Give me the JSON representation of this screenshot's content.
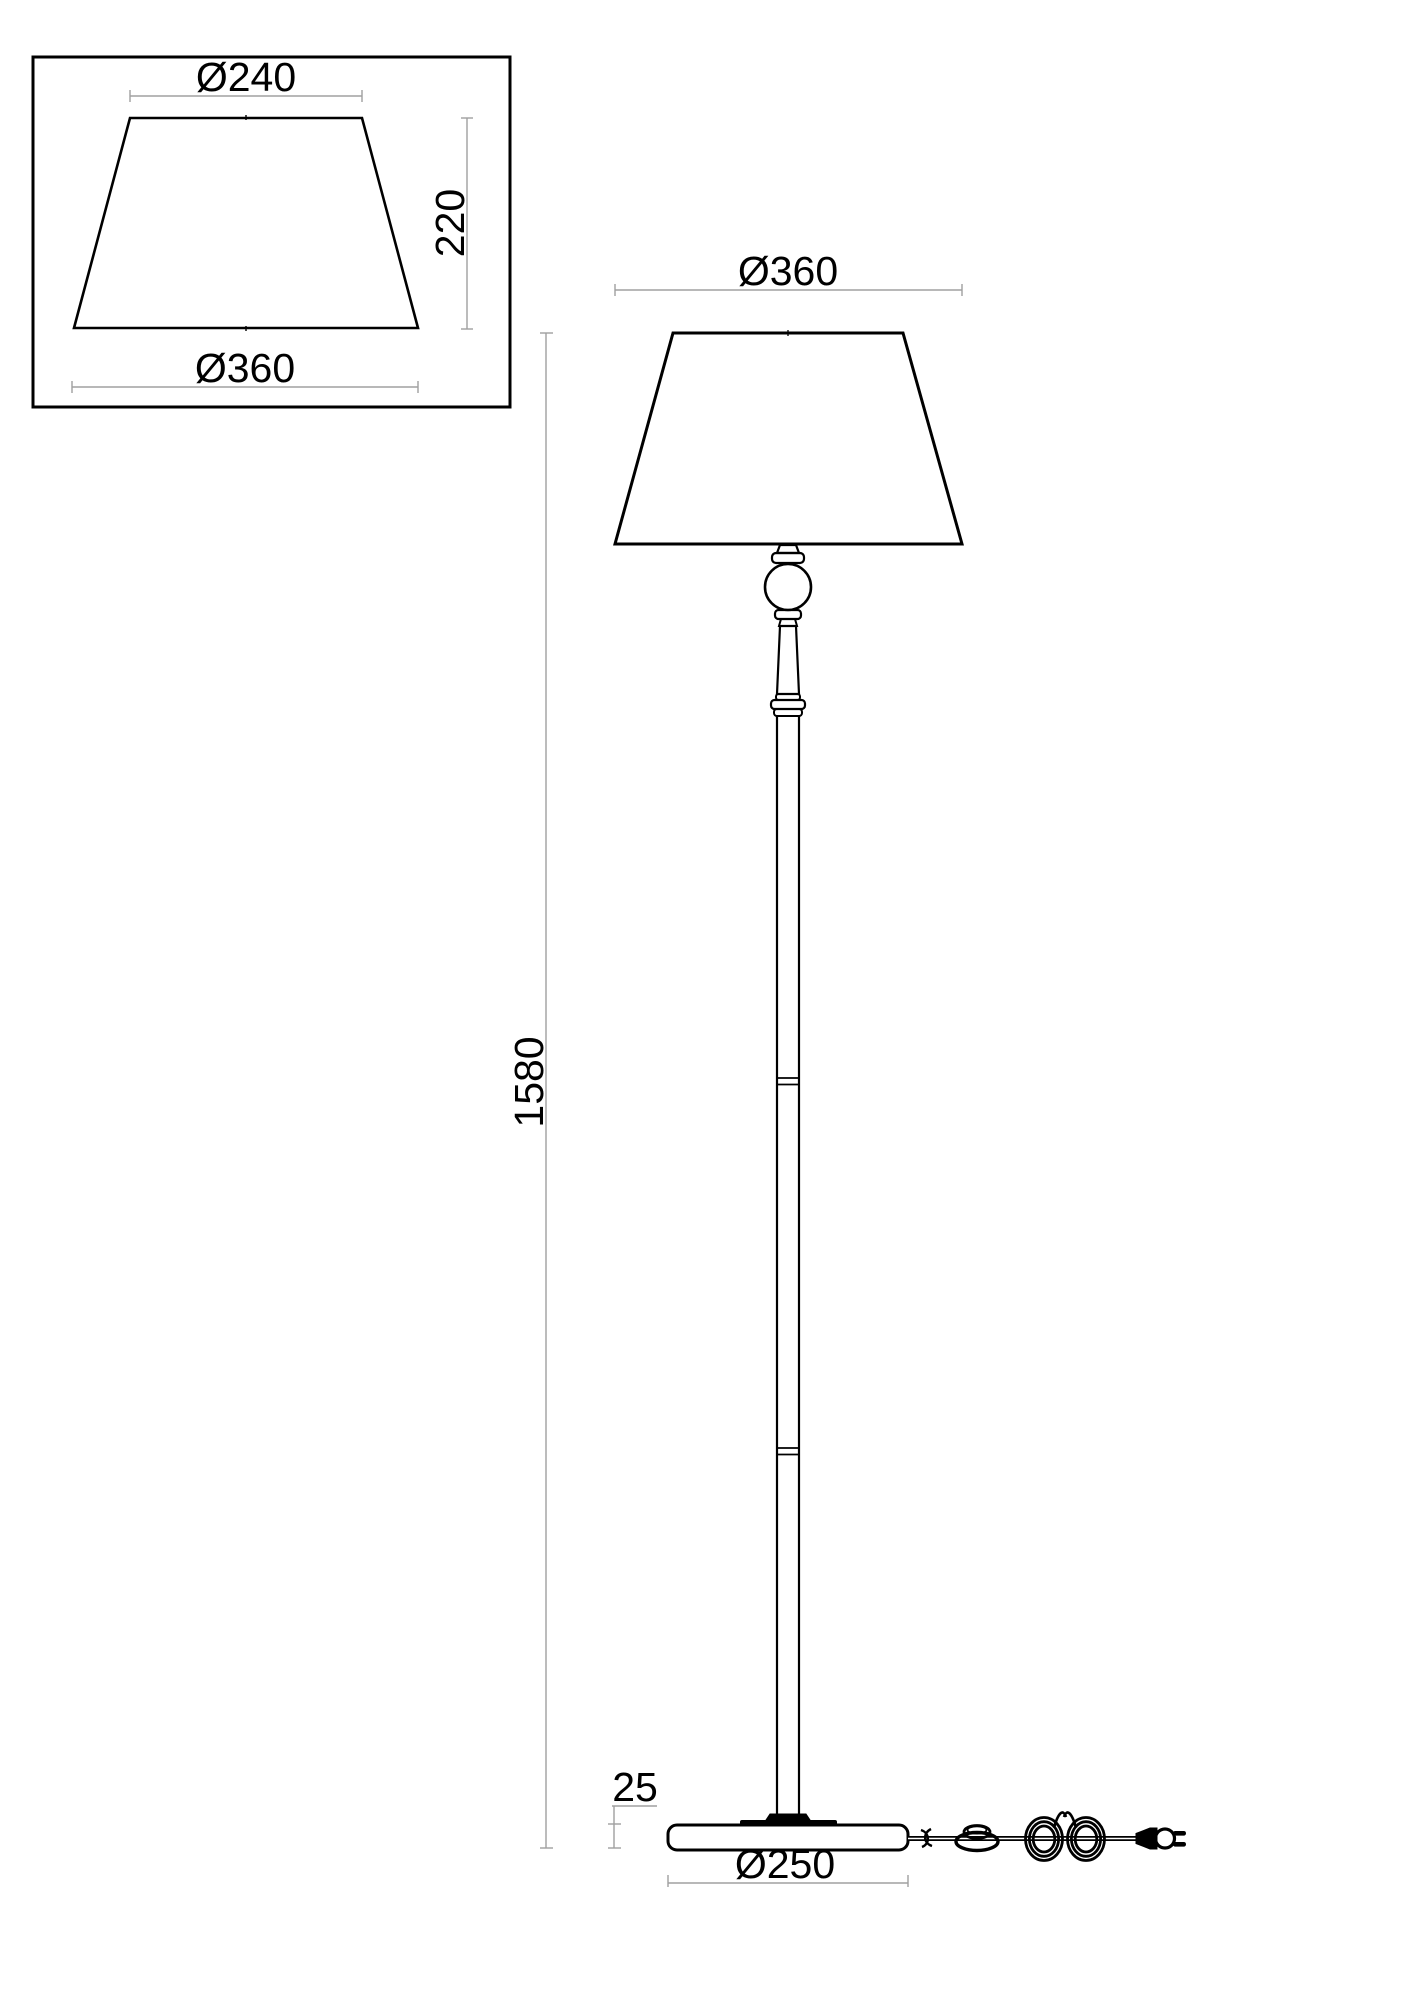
{
  "detail_view": {
    "top_diameter": "Ø240",
    "height": "220",
    "bottom_diameter": "Ø360"
  },
  "main_view": {
    "shade_diameter": "Ø360",
    "total_height": "1580",
    "base_height": "25",
    "base_diameter": "Ø250"
  },
  "colors": {
    "object_line": "#000000",
    "dimension_line": "#a0a0a0",
    "background": "#ffffff"
  }
}
